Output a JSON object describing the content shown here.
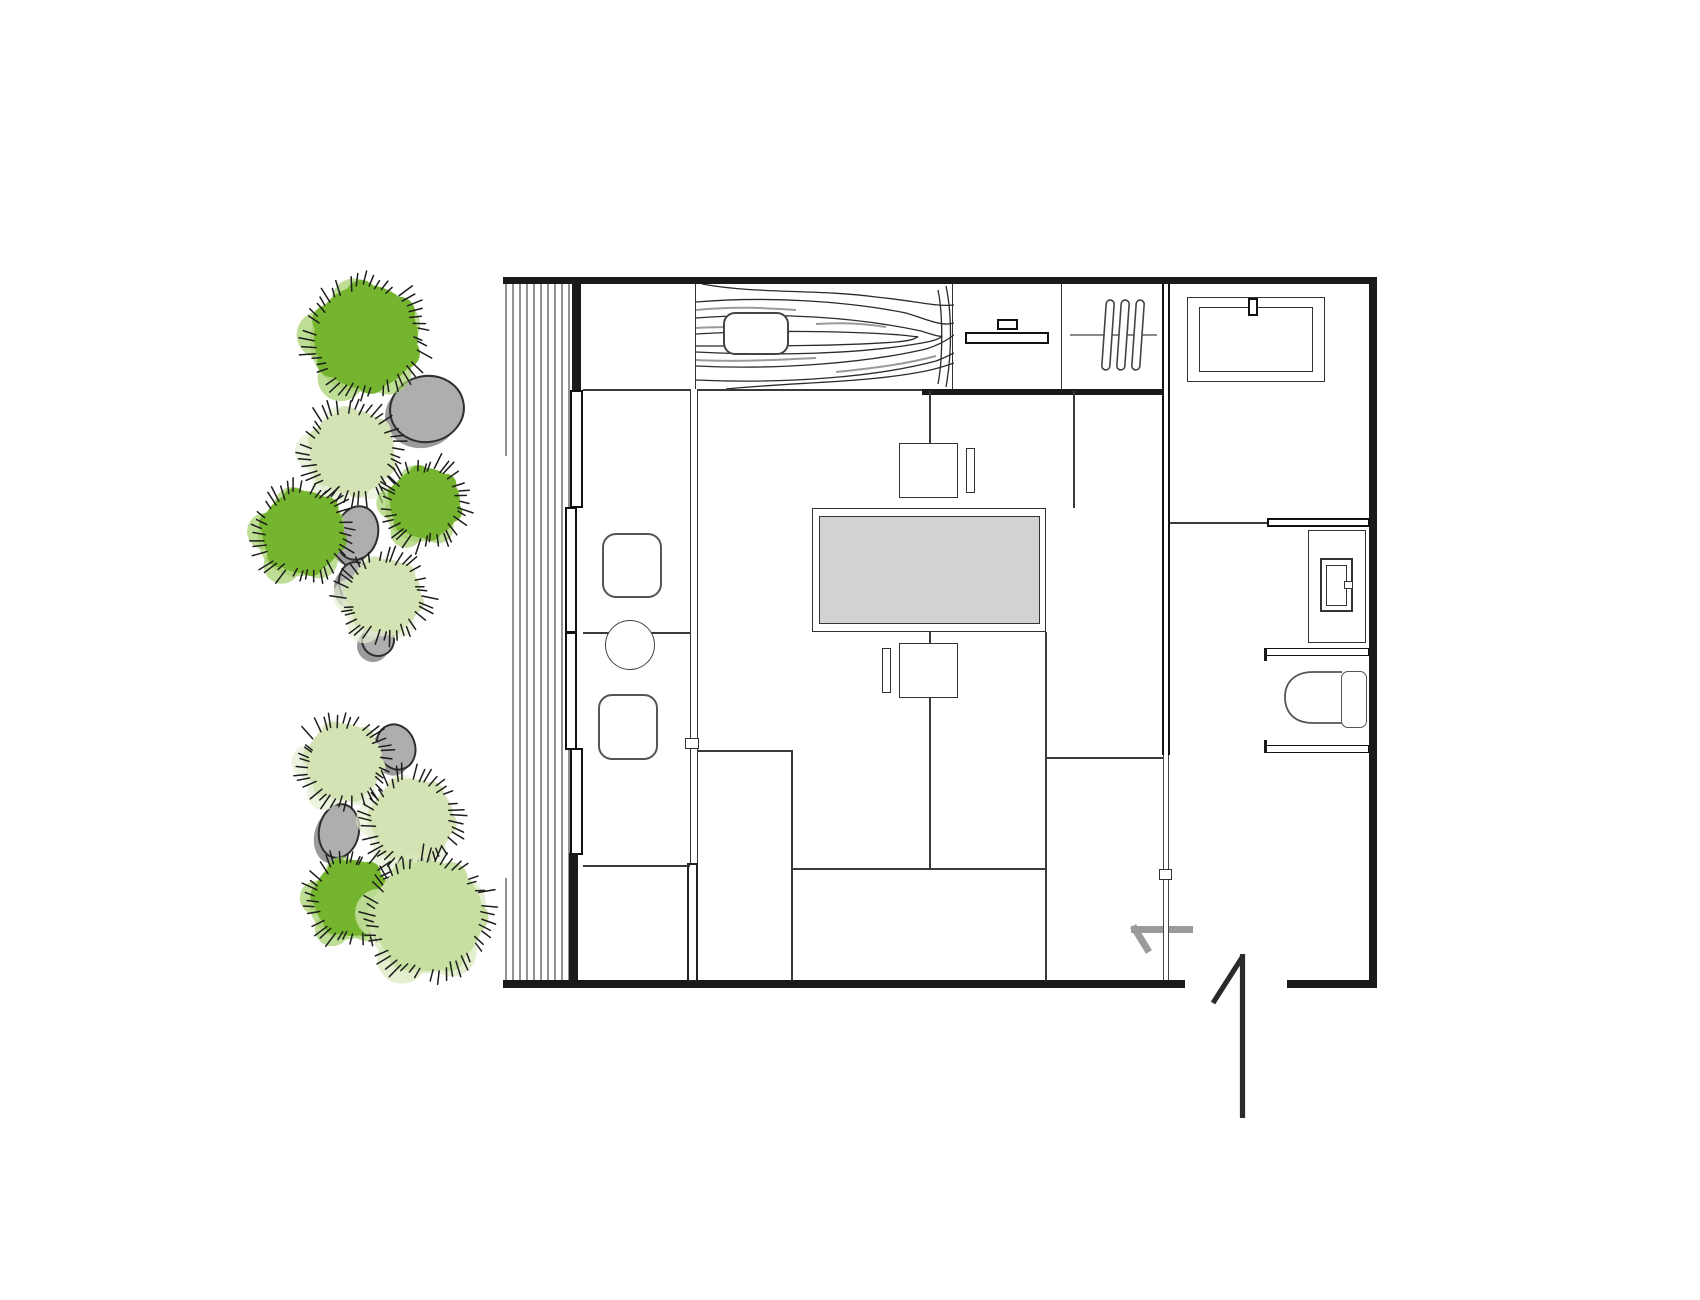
{
  "canvas": {
    "width": 1700,
    "height": 1300,
    "background": "#ffffff"
  },
  "palette": {
    "wall": "#1a1a1a",
    "line": "#3a3a3a",
    "line_medium": "#555555",
    "table_fill": "#d2d2d2",
    "green_dark": "#74b42e",
    "green_light": "#d3e3b3",
    "green_mid": "#c8dfa2",
    "halo_dark": "#a3cf68",
    "halo_light": "#e4eed2",
    "halo_mid": "#d9e8bc",
    "rock_fill": "#aeaeae",
    "rock_shadow": "#9b9b9b",
    "rock_stroke": "#2f2f2f",
    "hatch": "#1d1d1d",
    "arrow_gray": "#9b9b9b",
    "door_dark": "#2a2a2a",
    "grain": "#2b2b2b",
    "grain_gray": "#9a9a9a"
  },
  "garden": {
    "bushes": [
      {
        "cx": 366,
        "cy": 337,
        "r": 52,
        "shade": "dark"
      },
      {
        "cx": 352,
        "cy": 452,
        "r": 42,
        "shade": "light"
      },
      {
        "cx": 425,
        "cy": 503,
        "r": 35,
        "shade": "dark"
      },
      {
        "cx": 303,
        "cy": 532,
        "r": 41,
        "shade": "dark"
      },
      {
        "cx": 384,
        "cy": 596,
        "r": 37,
        "shade": "light"
      },
      {
        "cx": 344,
        "cy": 762,
        "r": 38,
        "shade": "light"
      },
      {
        "cx": 412,
        "cy": 820,
        "r": 41,
        "shade": "light"
      },
      {
        "cx": 352,
        "cy": 898,
        "r": 38,
        "shade": "dark"
      },
      {
        "cx": 428,
        "cy": 916,
        "r": 55,
        "shade": "mid"
      }
    ],
    "rocks": [
      {
        "cx": 427,
        "cy": 409,
        "rx": 37,
        "ry": 33,
        "rot": -10
      },
      {
        "cx": 357,
        "cy": 533,
        "rx": 21,
        "ry": 27,
        "rot": 12
      },
      {
        "cx": 356,
        "cy": 583,
        "rx": 17,
        "ry": 21,
        "rot": -8
      },
      {
        "cx": 378,
        "cy": 640,
        "rx": 16,
        "ry": 16,
        "rot": 18
      },
      {
        "cx": 396,
        "cy": 747,
        "rx": 19,
        "ry": 23,
        "rot": -20
      },
      {
        "cx": 339,
        "cy": 831,
        "rx": 20,
        "ry": 27,
        "rot": 10
      }
    ]
  },
  "deck": {
    "x_first": 506,
    "step": 7,
    "count": 10,
    "y_top": 284,
    "y_bottom": 981,
    "partial_first_segments": [
      [
        284,
        456
      ],
      [
        878,
        981
      ]
    ]
  },
  "entry": {
    "arrow": {
      "shaft": [
        1193,
        929.5,
        1131,
        929.5
      ],
      "barb": [
        1133,
        926,
        1149,
        952
      ],
      "width": 7
    },
    "door": {
      "leaf": [
        1242.5,
        954,
        1242.5,
        1118
      ],
      "swing": [
        1213,
        1003,
        1243,
        956
      ],
      "width": 5.2
    }
  },
  "radiator": {
    "cross_line": [
      1070,
      335,
      1157,
      335
    ],
    "bar_centers_x": [
      1108,
      1123,
      1138
    ],
    "bar_y": 300,
    "bar_h": 70,
    "tilt": 4
  }
}
